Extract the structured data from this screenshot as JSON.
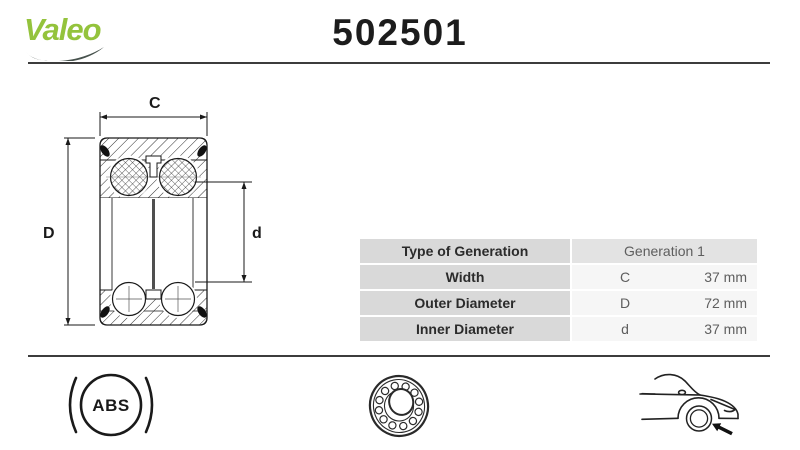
{
  "header": {
    "brand": "Valeo",
    "part_number": "502501"
  },
  "diagram": {
    "description": "wheel-bearing cross-section technical drawing",
    "dim_width_label": "C",
    "dim_outer_label": "D",
    "dim_inner_label": "d"
  },
  "spec_table": {
    "rows": [
      {
        "label": "Type of Generation",
        "symbol": "",
        "value": "Generation 1"
      },
      {
        "label": "Width",
        "symbol": "C",
        "value": "37 mm"
      },
      {
        "label": "Outer Diameter",
        "symbol": "D",
        "value": "72 mm"
      },
      {
        "label": "Inner Diameter",
        "symbol": "d",
        "value": "37 mm"
      }
    ]
  },
  "footer_icons": {
    "abs_label": "ABS",
    "bearing_icon": "bearing-photo-icon",
    "vehicle_icon": "car-front-wheel-location-icon"
  },
  "colors": {
    "brand_green": "#94C33C",
    "swoosh_dark": "#47524D",
    "rule_dark": "#3C3C3C",
    "table_label_bg": "#D9D9D9",
    "table_gen_bg": "#E3E3E3",
    "table_value_bg": "#F6F6F6",
    "label_text": "#2B2B2B",
    "value_text": "#5E5E5E"
  }
}
